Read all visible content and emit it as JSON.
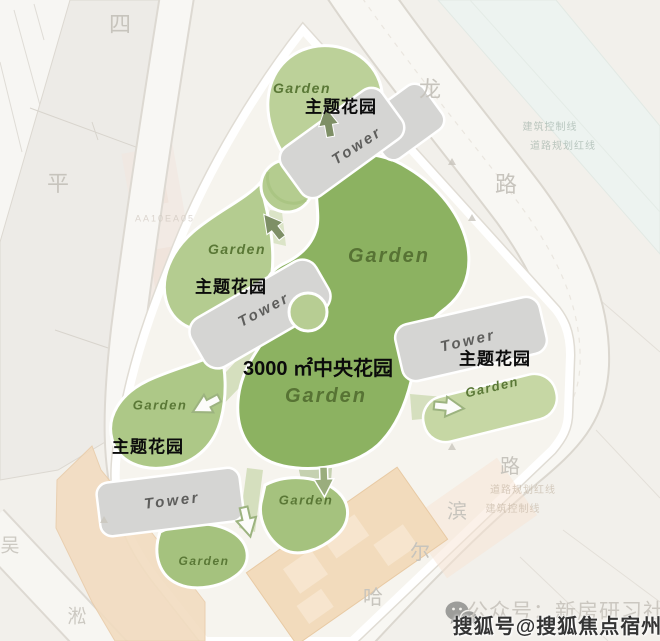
{
  "plan": {
    "garden_label": "Garden",
    "tower_label": "Tower",
    "theme_garden_label": "主题花园",
    "central_garden_label": "3000 ㎡中央花园"
  },
  "streets": {
    "siping": [
      "四",
      "平"
    ],
    "long_road": [
      "龙",
      "路"
    ],
    "haerbin": [
      "哈",
      "尔",
      "滨",
      "路"
    ],
    "wusong": [
      "吴",
      "淞"
    ]
  },
  "annotations": {
    "building_control_line": "建筑控制线",
    "road_planning_red_line": "道路规划红线",
    "plot_code": "AA10EA05"
  },
  "footer": {
    "wechat_watermark": "公众号：新房研习社",
    "sohu_watermark": "搜狐号@搜狐焦点宿州站"
  },
  "colors": {
    "central_garden_green": "#8cb261",
    "light_garden_green": "#b7cd94",
    "medium_garden_green": "#a3c07c",
    "garden_band_green": "#c6d7a4",
    "tower_gray": "#d5d5d3",
    "retained_building_tan": "#f2dbbc",
    "water_tint": "#edf3f0",
    "road_white": "#f8f7f3",
    "label_black": "#0b0b0b",
    "garden_text_green": "#5a7836",
    "street_text_gray": "#c7c4bd",
    "watermark_dark": "#343434"
  }
}
